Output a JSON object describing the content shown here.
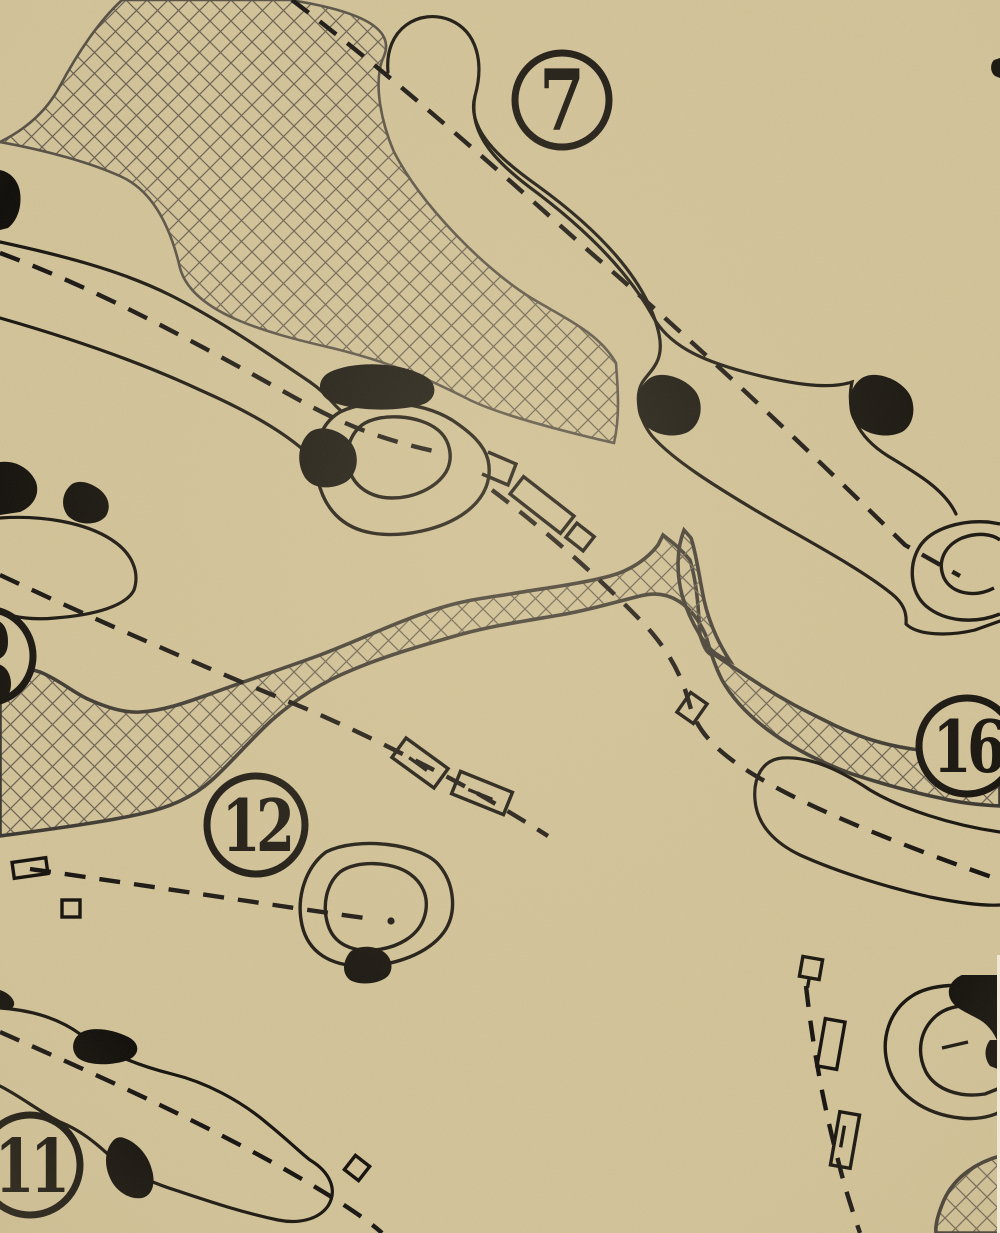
{
  "map": {
    "title": "Vintage golf course map section",
    "background_color": "#d5c69c",
    "ink_color": "#15120e",
    "water_outline_color": "#3b3731",
    "lake_outline_color": "#565046",
    "hatch_color": "#6a6254",
    "edge_strip_color": "#f0e9d7"
  },
  "hole_markers": [
    {
      "number": "7"
    },
    {
      "number": "12"
    },
    {
      "number": "16"
    },
    {
      "number": "11"
    }
  ]
}
